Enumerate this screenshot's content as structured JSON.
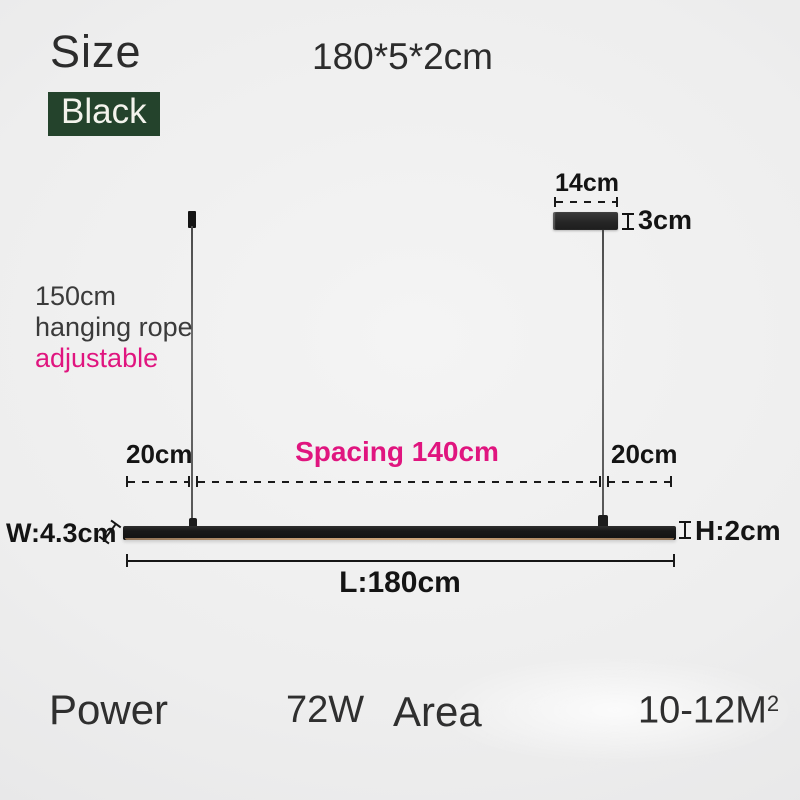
{
  "page": {
    "size_label": "Size",
    "size_value": "180*5*2cm",
    "color_option": "Black"
  },
  "canopy": {
    "width": "14cm",
    "height": "3cm"
  },
  "rope_info": {
    "line1": "150cm",
    "line2": "hanging rope",
    "line3": "adjustable"
  },
  "spacing": {
    "left": "20cm",
    "center": "Spacing 140cm",
    "right": "20cm"
  },
  "fixture": {
    "width": "W:4.3cm",
    "height": "H:2cm",
    "length": "L:180cm"
  },
  "specs": {
    "power_label": "Power",
    "power_value": "72W",
    "area_label": "Area",
    "area_value": "10-12M",
    "area_exponent": "2"
  },
  "colors": {
    "accent_pink": "#e0157f",
    "badge_green": "#24432c",
    "fixture_black": "#191919",
    "background_gray": "#ededed"
  }
}
